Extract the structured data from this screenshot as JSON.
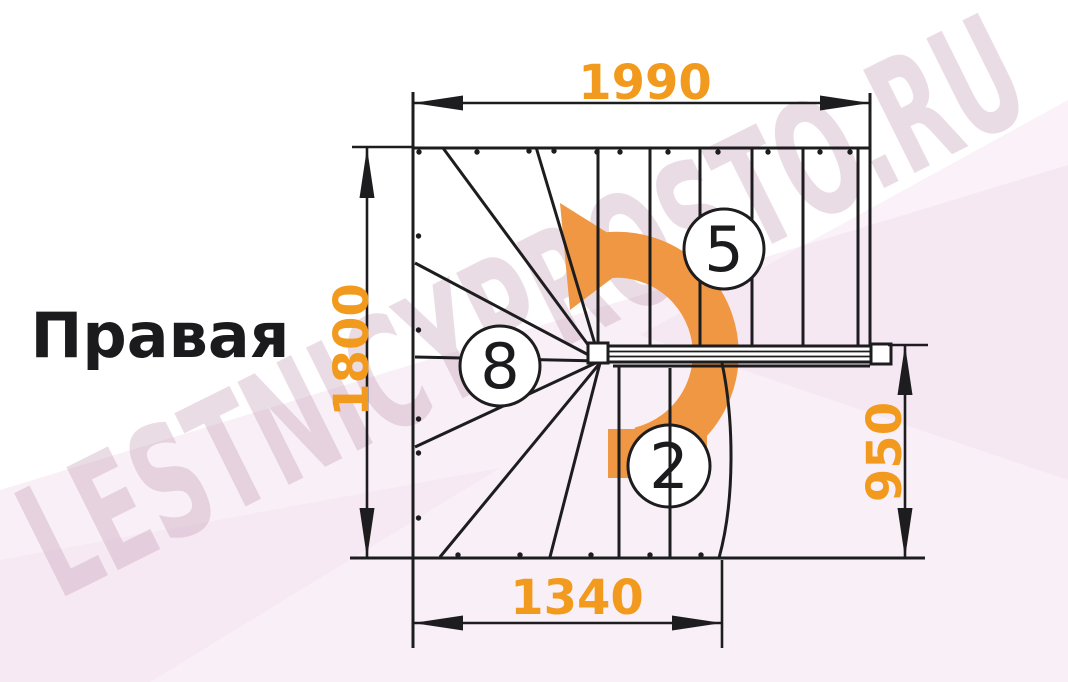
{
  "title": {
    "label": "Правая"
  },
  "watermark": {
    "text": "LESTNICYPROSTO.RU"
  },
  "staircase": {
    "view": "top-view-plan",
    "handedness_label": "Правая",
    "dimensions_mm": {
      "overall_width": "1990",
      "overall_depth": "1800",
      "landing_offset": "950",
      "lower_flight_width": "1340"
    },
    "step_labels": {
      "upper_flight": "5",
      "winder_fan": "8",
      "lower_flight": "2"
    },
    "colors": {
      "dimension_text": "#F29A1D",
      "rotation_arrow": "#EF9742",
      "drawing_lines": "#1D1D1F",
      "watermark": "#BB8FA9",
      "background_shards": "#F3DFEE"
    }
  }
}
